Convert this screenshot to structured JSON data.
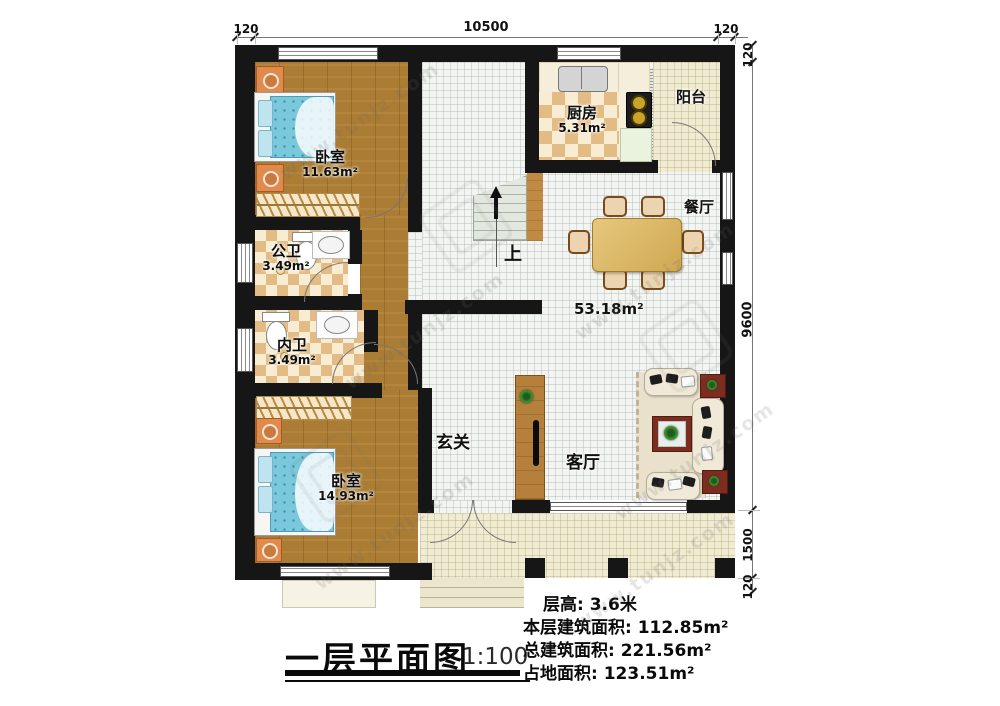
{
  "plan": {
    "rooms": {
      "bedroom_top": {
        "name": "卧室",
        "area": "11.63m²"
      },
      "bedroom_bottom": {
        "name": "卧室",
        "area": "14.93m²"
      },
      "kitchen": {
        "name": "厨房",
        "area": "5.31m²"
      },
      "balcony": {
        "name": "阳台"
      },
      "dining": {
        "name": "餐厅"
      },
      "living": {
        "name": "客厅"
      },
      "entry": {
        "name": "玄关"
      },
      "public_bathroom": {
        "name": "公卫",
        "area": "3.49m²"
      },
      "inner_bathroom": {
        "name": "内卫",
        "area": "3.49m²"
      }
    },
    "open_area_label": "53.18m²",
    "stairs_label": "上"
  },
  "dimensions": {
    "top": [
      "120",
      "10500",
      "120"
    ],
    "right": [
      "120",
      "9600",
      "1500",
      "120"
    ]
  },
  "title_block": {
    "title": "一层平面图",
    "scale": "1:100"
  },
  "info_lines": [
    "层高: 3.6米",
    "本层建筑面积: 112.85m²",
    "总建筑面积: 221.56m²",
    "占地面积: 123.51m²"
  ],
  "watermark": {
    "text": "www.tunjz.com"
  },
  "colors": {
    "wall": "#161616",
    "wood": "#ab7c33",
    "checker_dark": "#e3bb85",
    "checker_light": "#f8edd3",
    "mattress_blue": "#79c8dc",
    "table_tan": "#dcba6a",
    "accent_red": "#7c2d1f"
  }
}
